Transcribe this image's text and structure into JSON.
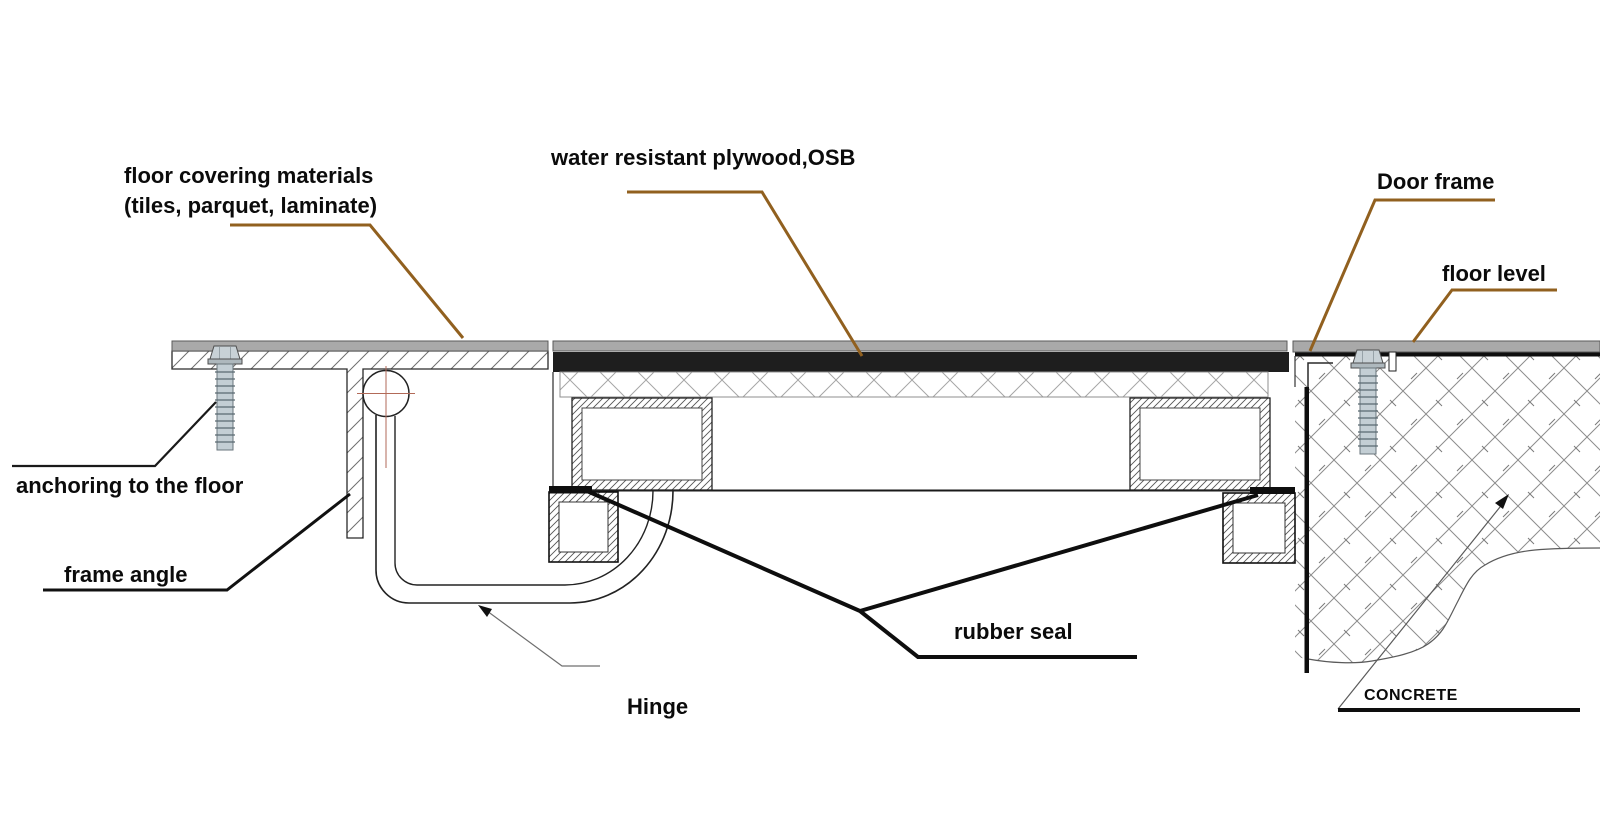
{
  "diagram": {
    "type": "technical-cross-section",
    "subject": "hidden floor access hatch / trap door construction detail",
    "labels": {
      "floor_covering_line1": "floor covering materials",
      "floor_covering_line2": "(tiles, parquet, laminate)",
      "plywood": "water resistant plywood,OSB",
      "door_frame": "Door frame",
      "floor_level": "floor level",
      "anchoring": "anchoring to the floor",
      "frame_angle": "frame angle",
      "hinge": "Hinge",
      "rubber_seal": "rubber seal",
      "concrete": "CONCRETE"
    },
    "colors": {
      "leader_brown": "#91601f",
      "floor_covering_gray": "#a9a9a9",
      "plywood_black": "#1e1e1e",
      "rubber_seal_black": "#0e0e0e",
      "drawing_line": "#222222",
      "hatch_gray": "#8a8a8a",
      "hinge_crosshair": "#b26a58",
      "screw_steel": "#c3ced4"
    }
  }
}
